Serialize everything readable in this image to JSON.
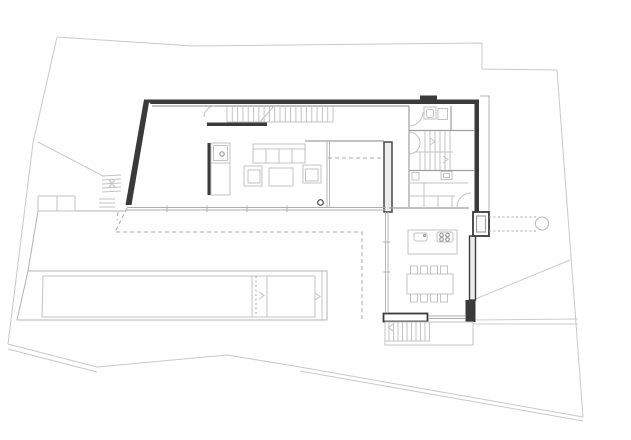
{
  "canvas": {
    "width": 631,
    "height": 440
  },
  "drawing": {
    "kind": "architectural-floor-plan",
    "visible_text": "",
    "components": [
      "site-boundary",
      "terrain-lines",
      "exterior-walls",
      "slanted-west-wall",
      "north-stair",
      "entry-door-swing",
      "sideboard",
      "fireplace-wall",
      "fireplace-unit",
      "sofa",
      "armchair-left",
      "armchair-right",
      "coffee-table",
      "floor-drain",
      "bathroom",
      "toilet",
      "sink",
      "interior-stair",
      "utility-room",
      "utility-door-swing",
      "freestanding-wall",
      "entrance-niche",
      "entry-path-dotted",
      "entry-column",
      "kitchen-island",
      "island-sink",
      "cooktop",
      "dining-table",
      "dining-chairs",
      "south-glass-facade",
      "east-glass-wall",
      "west-glass-kitchen",
      "upper-floor-dashed-outline",
      "terrace",
      "terrace-steps-northwest",
      "pool",
      "pool-divider",
      "south-exterior-stair",
      "stair-platform"
    ]
  },
  "colors": {
    "background": "#ffffff",
    "site_boundary": "#c9c9c9",
    "terrain_line": "#cccccc",
    "wall_dark": "#3a3a3a",
    "wall_gray": "#ededed",
    "partition_line": "#9e9e9e",
    "furniture_line": "#c3c3c3",
    "glass_line": "#aeaeae",
    "dashed_line": "#a9a9a9",
    "pool_line": "#b3b3b3"
  }
}
